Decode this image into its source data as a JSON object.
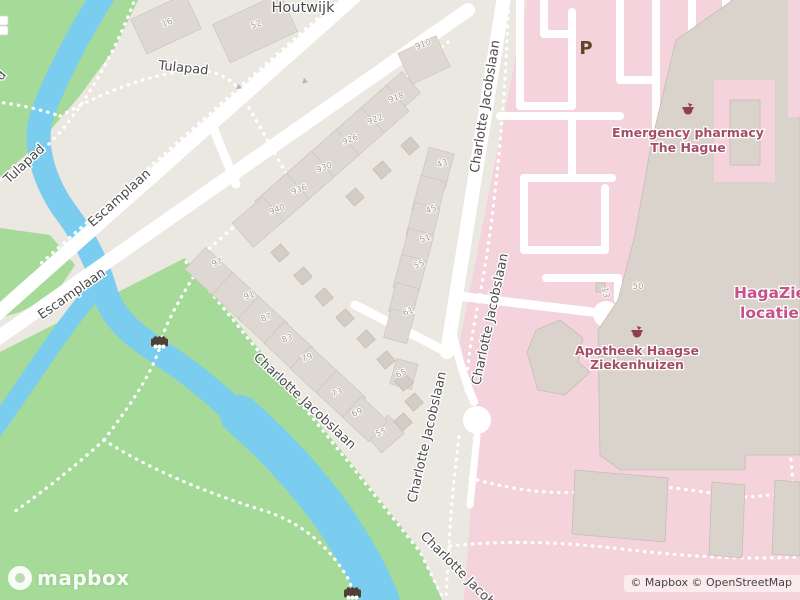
{
  "map": {
    "attribution": "© Mapbox © OpenStreetMap",
    "logo_text": "mapbox",
    "parking_label": "P",
    "colors": {
      "background": "#ebe7e1",
      "park_green": "#a5da98",
      "water_blue": "#7bcdf0",
      "hospital_pink": "#f5d3dc",
      "road_white": "#ffffff",
      "street_label": "#4b4b4b",
      "poi_text": "#a44e68",
      "haga_text": "#c75189",
      "parking_text": "#5e4429"
    },
    "pois": {
      "emergency_pharmacy": {
        "line1": "Emergency pharmacy",
        "line2": "The Hague"
      },
      "apotheek": {
        "line1": "Apotheek Haagse",
        "line2": "Ziekenhuizen"
      },
      "haga": {
        "line1": "HagaZiek",
        "line2": "locatie L"
      }
    },
    "street_labels": [
      {
        "t": "Houtwijk",
        "x": 303,
        "y": 12,
        "r": 0,
        "s": 14.5
      },
      {
        "t": "Tulapad",
        "x": 183,
        "y": 72,
        "r": 6,
        "s": 13
      },
      {
        "t": "Tulapad",
        "x": 27,
        "y": 167,
        "r": -43,
        "s": 13
      },
      {
        "t": "d",
        "x": 4,
        "y": 78,
        "r": -50,
        "s": 13
      },
      {
        "t": "Escamplaan",
        "x": 122,
        "y": 201,
        "r": -42,
        "s": 13
      },
      {
        "t": "Escamplaan",
        "x": 74,
        "y": 297,
        "r": -35,
        "s": 13
      },
      {
        "t": "Charlotte Jacobslaan",
        "x": 489,
        "y": 107,
        "r": -81,
        "s": 13
      },
      {
        "t": "Charlotte Jacobslaan",
        "x": 494,
        "y": 320,
        "r": -78,
        "s": 13
      },
      {
        "t": "Charlotte Jacobslaan",
        "x": 302,
        "y": 404,
        "r": 43,
        "s": 13
      },
      {
        "t": "Charlotte Jacobslaan",
        "x": 431,
        "y": 438,
        "r": -77,
        "s": 13
      },
      {
        "t": "Charlotte Jacob",
        "x": 455,
        "y": 572,
        "r": 45,
        "s": 13
      }
    ],
    "house_numbers": [
      {
        "t": "16",
        "x": 168,
        "y": 25,
        "r": -20
      },
      {
        "t": "52",
        "x": 257,
        "y": 27,
        "r": -20
      },
      {
        "t": "910",
        "x": 424,
        "y": 47,
        "r": -20
      },
      {
        "t": "918",
        "x": 397,
        "y": 100,
        "r": -20
      },
      {
        "t": "922",
        "x": 376,
        "y": 122,
        "r": -20
      },
      {
        "t": "926",
        "x": 351,
        "y": 142,
        "r": -20
      },
      {
        "t": "930",
        "x": 325,
        "y": 170,
        "r": -20
      },
      {
        "t": "936",
        "x": 300,
        "y": 192,
        "r": -20
      },
      {
        "t": "940",
        "x": 278,
        "y": 212,
        "r": -20
      },
      {
        "t": "43",
        "x": 443,
        "y": 166,
        "r": -20
      },
      {
        "t": "45",
        "x": 432,
        "y": 212,
        "r": -20
      },
      {
        "t": "51",
        "x": 426,
        "y": 241,
        "r": -20
      },
      {
        "t": "55",
        "x": 420,
        "y": 267,
        "r": -20
      },
      {
        "t": "97",
        "x": 218,
        "y": 265,
        "r": -20
      },
      {
        "t": "91",
        "x": 250,
        "y": 298,
        "r": -20
      },
      {
        "t": "87",
        "x": 267,
        "y": 320,
        "r": -20
      },
      {
        "t": "83",
        "x": 288,
        "y": 341,
        "r": -20
      },
      {
        "t": "79",
        "x": 308,
        "y": 360,
        "r": -20
      },
      {
        "t": "73",
        "x": 338,
        "y": 395,
        "r": -20
      },
      {
        "t": "69",
        "x": 358,
        "y": 415,
        "r": -20
      },
      {
        "t": "61",
        "x": 409,
        "y": 314,
        "r": -20
      },
      {
        "t": "65",
        "x": 402,
        "y": 376,
        "r": -20
      },
      {
        "t": "55",
        "x": 382,
        "y": 435,
        "r": -20
      },
      {
        "t": "50",
        "x": 638,
        "y": 289,
        "r": 0
      },
      {
        "t": "13",
        "x": 603,
        "y": 293,
        "r": 80
      }
    ]
  }
}
